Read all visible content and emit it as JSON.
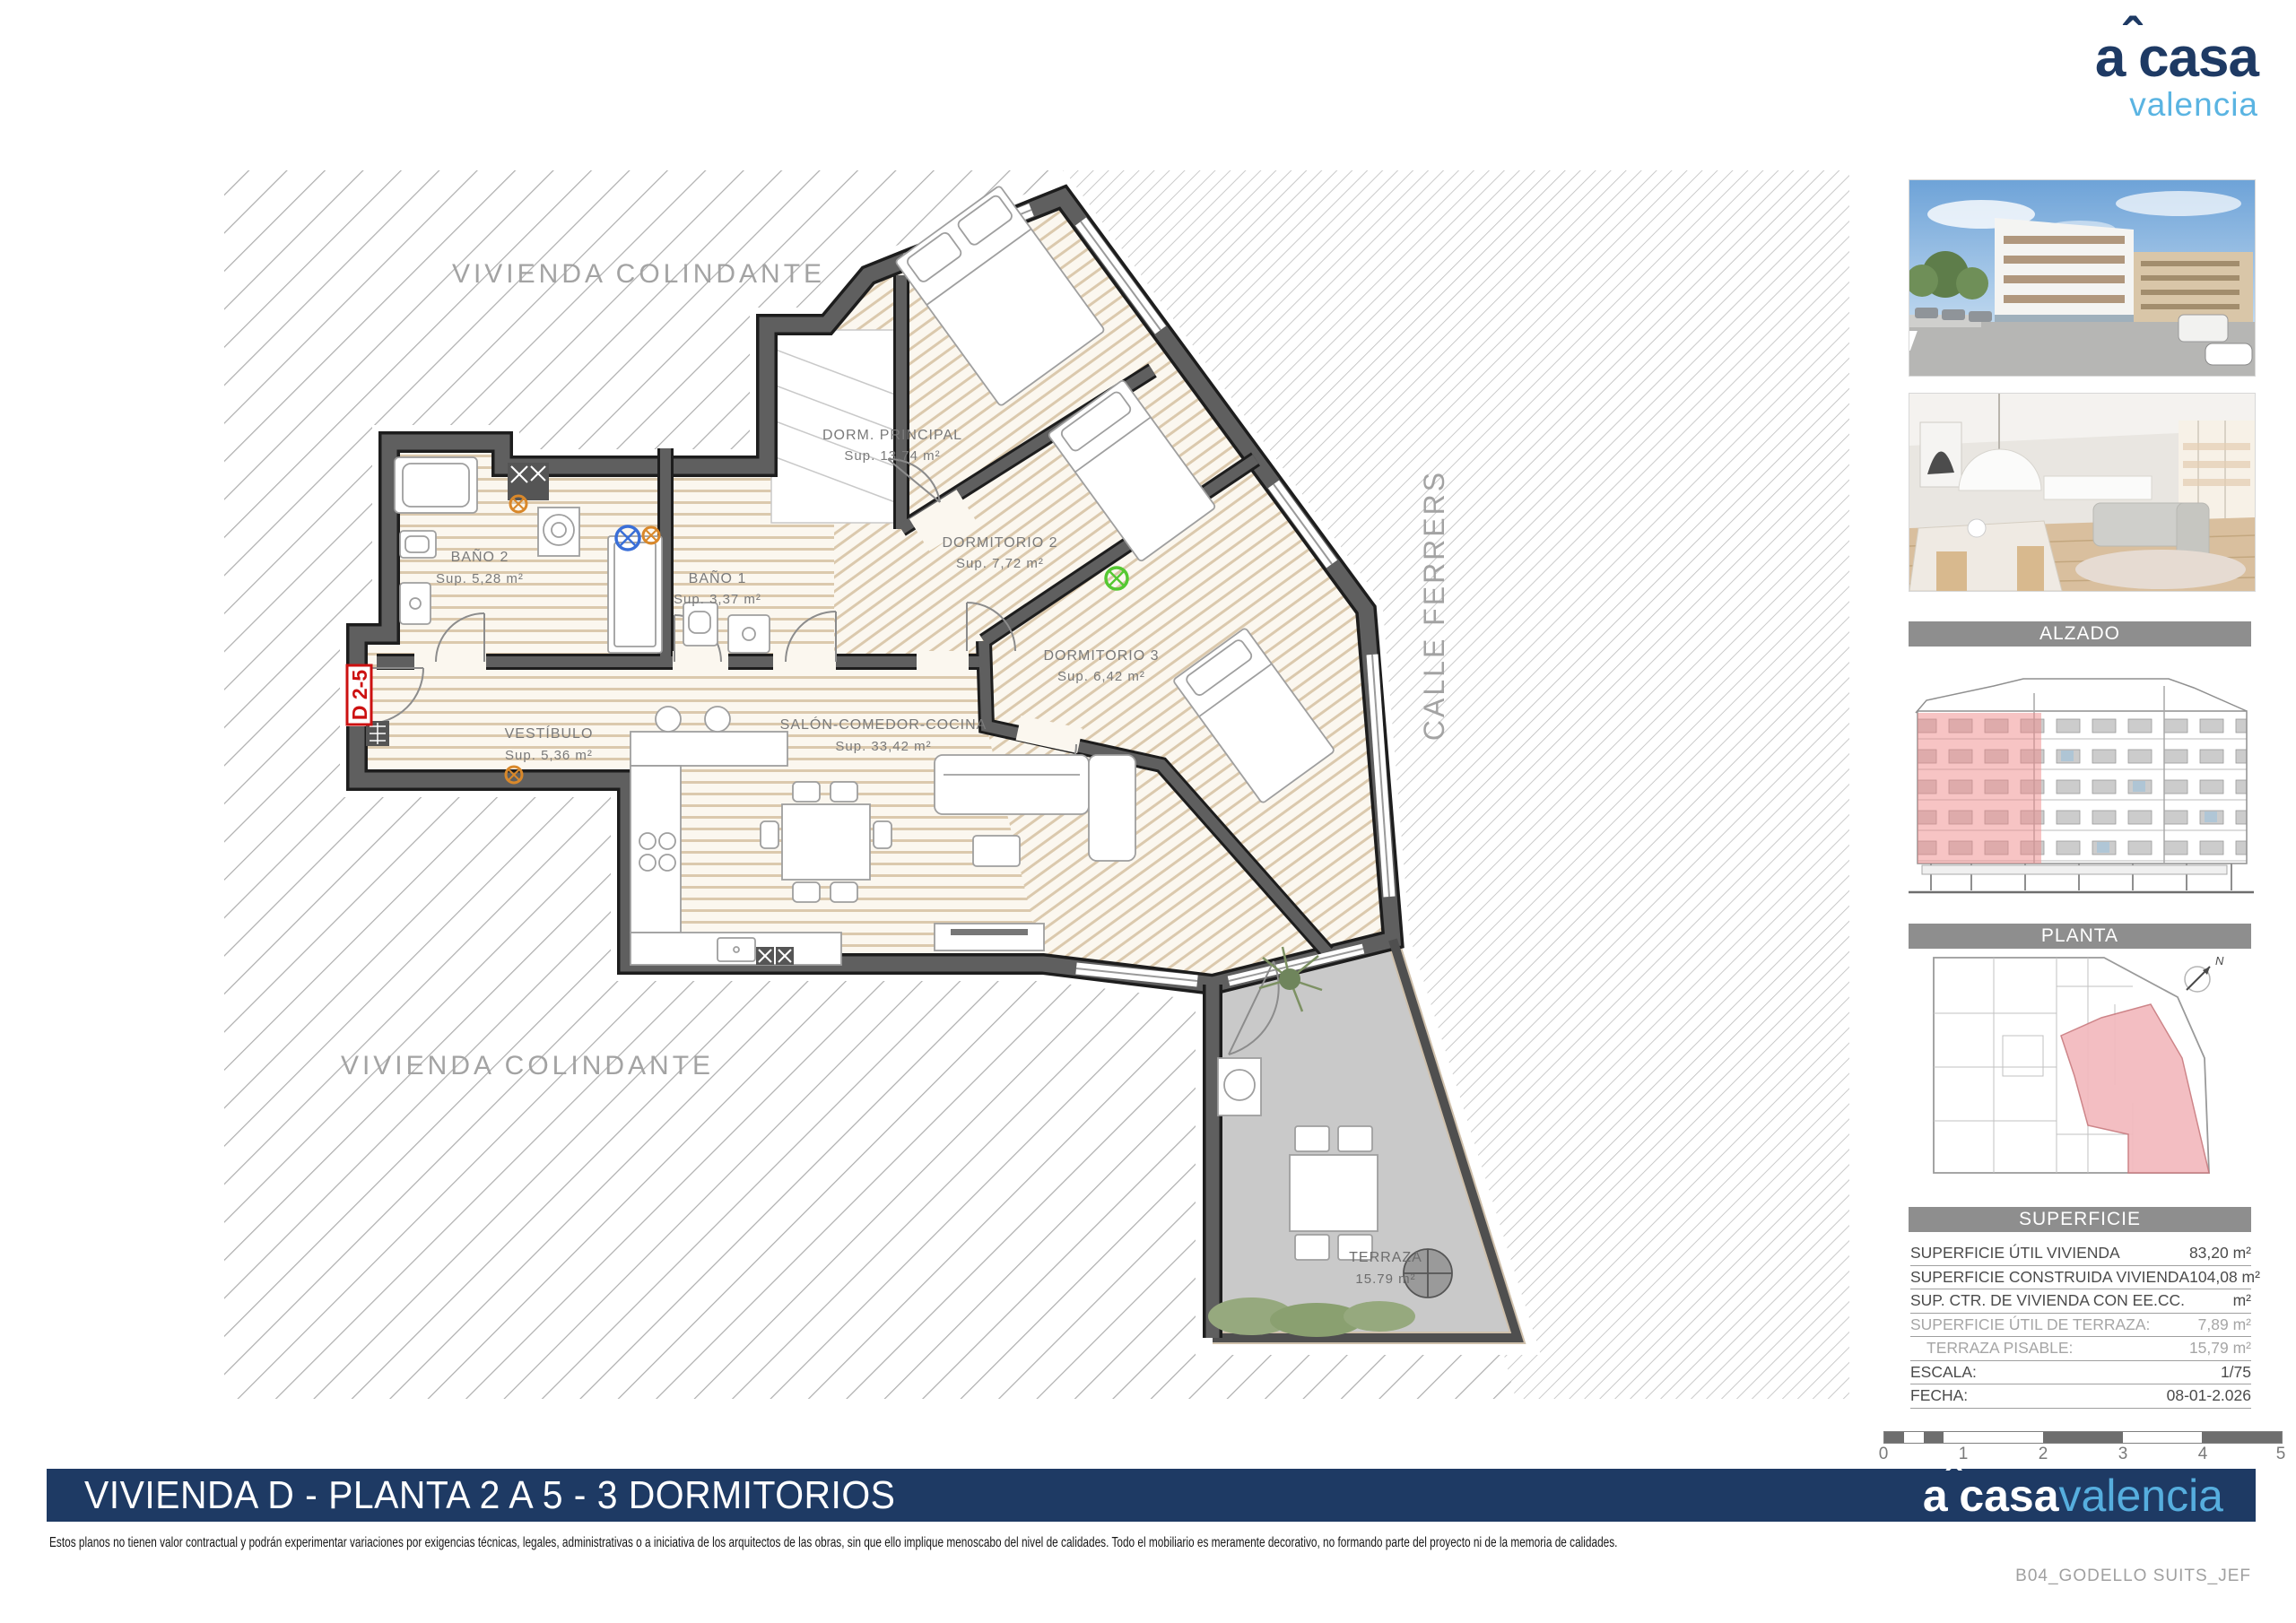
{
  "logo": {
    "a": "a",
    "caret": "ˆ",
    "casa": "casa",
    "sub": "valencia"
  },
  "plan": {
    "adjacent_top": "VIVIENDA COLINDANTE",
    "adjacent_bottom": "VIVIENDA COLINDANTE",
    "street": "CALLE FERRERS",
    "unit_tag": "D 2-5",
    "rooms": {
      "dorm_principal": {
        "name": "DORM. PRINCIPAL",
        "area": "Sup. 13,74 m²"
      },
      "dormitorio2": {
        "name": "DORMITORIO 2",
        "area": "Sup. 7,72 m²"
      },
      "dormitorio3": {
        "name": "DORMITORIO 3",
        "area": "Sup. 6,42 m²"
      },
      "bano2": {
        "name": "BAÑO 2",
        "area": "Sup. 5,28 m²"
      },
      "bano1": {
        "name": "BAÑO 1",
        "area": "Sup. 3,37 m²"
      },
      "vestibulo": {
        "name": "VESTÍBULO",
        "area": "Sup. 5,36 m²"
      },
      "salon": {
        "name": "SALÓN-COMEDOR-COCINA",
        "area": "Sup. 33,42 m²"
      },
      "terraza": {
        "name": "TERRAZA",
        "area": "15.79 m²"
      }
    }
  },
  "sidebar": {
    "alzado_title": "ALZADO",
    "planta_title": "PLANTA",
    "superficie_title": "SUPERFICIE",
    "table": {
      "rows": [
        {
          "label": "SUPERFICIE ÚTIL VIVIENDA",
          "value": "83,20 m²"
        },
        {
          "label": "SUPERFICIE CONSTRUIDA VIVIENDA",
          "value": "104,08 m²"
        },
        {
          "label": "SUP. CTR. DE VIVIENDA CON EE.CC.",
          "value": "m²"
        },
        {
          "label": "SUPERFICIE ÚTIL DE TERRAZA:",
          "value": "7,89 m²"
        },
        {
          "label": "TERRAZA PISABLE:",
          "value": "15,79 m²"
        },
        {
          "label": "ESCALA:",
          "value": "1/75"
        },
        {
          "label": "FECHA:",
          "value": "08-01-2.026"
        }
      ]
    },
    "scalebar_ticks": [
      "0",
      "1",
      "2",
      "3",
      "4",
      "5"
    ]
  },
  "footer": {
    "title": "VIVIENDA D - PLANTA 2 A 5 - 3 DORMITORIOS",
    "disclaimer": "Estos planos no tienen valor contractual y podrán experimentar variaciones por exigencias técnicas, legales, administrativas o a iniciativa de los arquitectos de las obras, sin que ello implique menoscabo del nivel de calidades. Todo el mobiliario es meramente decorativo, no formando parte del proyecto ni de la memoria de calidades.",
    "file_ref": "B04_GODELLO SUITS_JEF"
  },
  "colors": {
    "navy": "#1e3a64",
    "light_blue": "#58b2e0",
    "header_gray": "#8e8e8e",
    "wall_gray": "#5f5f5f",
    "highlight_pink": "#f2b3b6",
    "accent_red": "#cc1111"
  }
}
